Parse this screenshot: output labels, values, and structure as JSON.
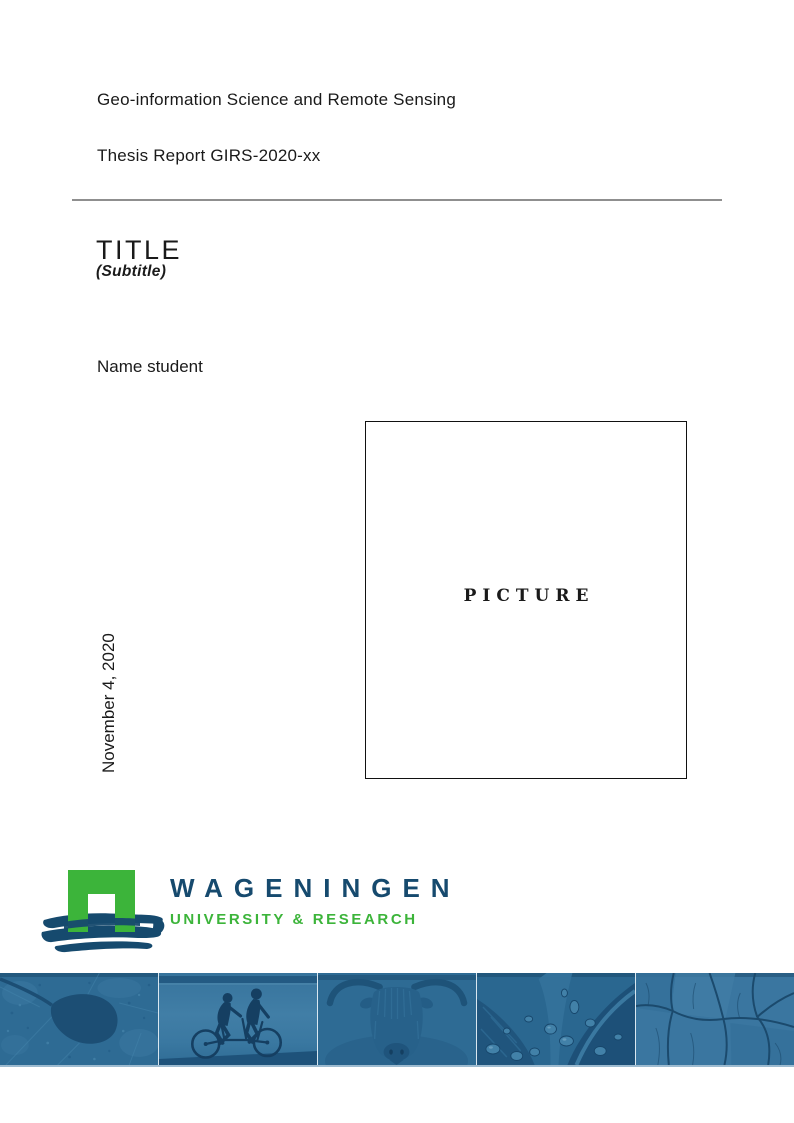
{
  "header": {
    "program": "Geo-information Science and Remote Sensing",
    "report_id": "Thesis Report GIRS-2020-xx"
  },
  "title": {
    "main": "TITLE",
    "subtitle": "(Subtitle)"
  },
  "author": {
    "name": "Name student"
  },
  "date": {
    "value": "November 4, 2020"
  },
  "picture": {
    "placeholder": "PICTURE"
  },
  "logo": {
    "name": "WAGENINGEN",
    "tagline": "UNIVERSITY & RESEARCH",
    "colors": {
      "green": "#3cb43a",
      "navy": "#164a6e"
    }
  },
  "banner": {
    "tiles": [
      {
        "name": "aerial-map"
      },
      {
        "name": "tandem-cyclists"
      },
      {
        "name": "highland-cow"
      },
      {
        "name": "leaf-droplets"
      },
      {
        "name": "cracked-earth"
      }
    ],
    "colors": {
      "base": "#2e6b94",
      "dark": "#1d5078",
      "darker": "#153f62",
      "light": "#4281a8"
    }
  }
}
